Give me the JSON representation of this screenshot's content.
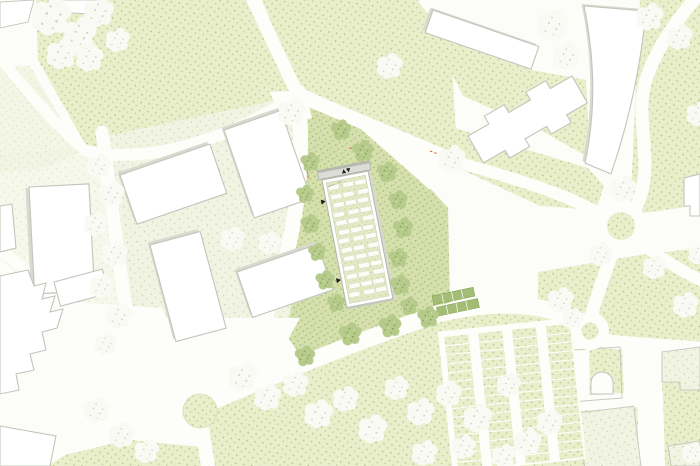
{
  "meta": {
    "type": "architectural-site-plan",
    "view": "top-down urban masterplan",
    "legible_text": "none"
  },
  "palette": {
    "paper": "#fcfdf8",
    "road_white": "#fdfdfa",
    "building_fill": "#ffffff",
    "building_outline": "#c2c5bb",
    "shadow": "#d8dacf",
    "field_green": "#e9eecb",
    "field_dot": "#b9c28b",
    "pale_green": "#f2f4e3",
    "pale_dot": "#c6cf9f",
    "lawn_green": "#d6e0ad",
    "lawn_dot": "#a0b273",
    "roof_green": "#e3e9c4",
    "roof_dot": "#b9c490",
    "tree_white": "#f8faf3",
    "tree_white_speck": "#cdd2c3",
    "tree_green": "#b6cb8b",
    "tree_green_speck": "#87a457",
    "marker_black": "#1c1c1c",
    "dash_orange": "#cc7544",
    "planting_dark": "#a3bd74"
  },
  "central_building": {
    "ramp_arrows": "▲▼",
    "grid": {
      "rows": 13,
      "cols": 3
    },
    "entrances": 2
  },
  "roundabouts": [
    {
      "name": "east-roundabout",
      "x": 621,
      "y": 226
    },
    {
      "name": "southeast-roundabout",
      "x": 590,
      "y": 331
    },
    {
      "name": "southwest-circle",
      "x": 200,
      "y": 411
    }
  ],
  "trees": {
    "white": [
      [
        52,
        16,
        1.3
      ],
      [
        80,
        34,
        1.1
      ],
      [
        99,
        12,
        1.0
      ],
      [
        62,
        54,
        1.0
      ],
      [
        90,
        58,
        0.9
      ],
      [
        118,
        40,
        0.8
      ],
      [
        292,
        112,
        0.9
      ],
      [
        390,
        66,
        0.85
      ],
      [
        99,
        166,
        0.8
      ],
      [
        112,
        194,
        0.85
      ],
      [
        96,
        224,
        0.8
      ],
      [
        115,
        254,
        0.85
      ],
      [
        102,
        286,
        0.8
      ],
      [
        119,
        316,
        0.85
      ],
      [
        106,
        344,
        0.75
      ],
      [
        233,
        239,
        0.8
      ],
      [
        270,
        243,
        0.75
      ],
      [
        452,
        159,
        0.9
      ],
      [
        553,
        25,
        1.0
      ],
      [
        567,
        56,
        0.9
      ],
      [
        650,
        17,
        0.9
      ],
      [
        680,
        37,
        0.85
      ],
      [
        699,
        114,
        0.8
      ],
      [
        624,
        189,
        0.85
      ],
      [
        601,
        254,
        0.8
      ],
      [
        655,
        267,
        0.8
      ],
      [
        686,
        305,
        0.85
      ],
      [
        699,
        254,
        0.7
      ],
      [
        561,
        300,
        0.85
      ],
      [
        573,
        319,
        0.7
      ],
      [
        243,
        377,
        0.95
      ],
      [
        268,
        397,
        0.9
      ],
      [
        296,
        384,
        0.85
      ],
      [
        319,
        414,
        0.95
      ],
      [
        346,
        399,
        0.85
      ],
      [
        373,
        429,
        0.95
      ],
      [
        397,
        388,
        0.8
      ],
      [
        421,
        412,
        0.9
      ],
      [
        449,
        394,
        0.85
      ],
      [
        478,
        418,
        0.95
      ],
      [
        509,
        385,
        0.8
      ],
      [
        528,
        442,
        0.9
      ],
      [
        550,
        422,
        0.85
      ],
      [
        425,
        453,
        0.85
      ],
      [
        464,
        447,
        0.8
      ],
      [
        504,
        456,
        0.8
      ],
      [
        97,
        410,
        0.85
      ],
      [
        122,
        435,
        0.85
      ],
      [
        147,
        451,
        0.8
      ],
      [
        693,
        453,
        0.7
      ]
    ],
    "green": [
      [
        310,
        162,
        0.8
      ],
      [
        305,
        194,
        0.75
      ],
      [
        310,
        224,
        0.8
      ],
      [
        317,
        252,
        0.75
      ],
      [
        325,
        280,
        0.8
      ],
      [
        336,
        303,
        0.75
      ],
      [
        341,
        130,
        0.85
      ],
      [
        363,
        151,
        0.9
      ],
      [
        387,
        172,
        0.85
      ],
      [
        398,
        200,
        0.8
      ],
      [
        403,
        228,
        0.85
      ],
      [
        398,
        258,
        0.8
      ],
      [
        400,
        285,
        0.85
      ],
      [
        409,
        306,
        0.75
      ],
      [
        350,
        334,
        0.95
      ],
      [
        390,
        326,
        0.95
      ],
      [
        428,
        317,
        0.9
      ],
      [
        305,
        356,
        0.85
      ]
    ]
  }
}
